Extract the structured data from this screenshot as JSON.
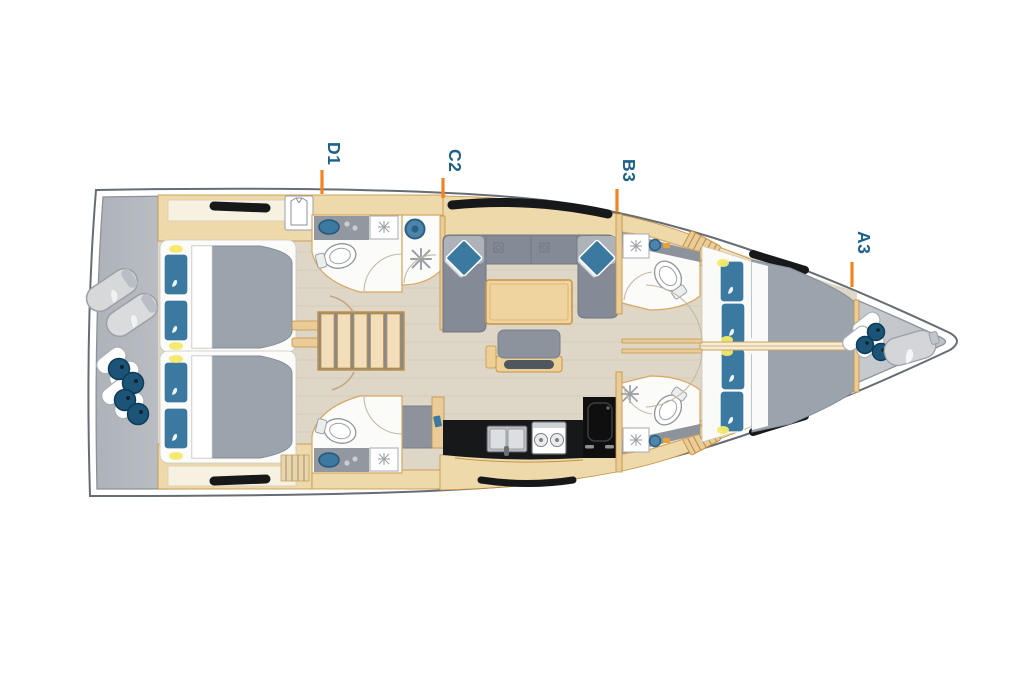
{
  "plan": {
    "type": "sailing-yacht-deck-plan",
    "cabin_labels": [
      {
        "id": "cabin-d1",
        "label": "D1"
      },
      {
        "id": "cabin-c2",
        "label": "C2"
      },
      {
        "id": "cabin-b3",
        "label": "B3"
      },
      {
        "id": "cabin-a3",
        "label": "A3"
      }
    ],
    "colors": {
      "label_text": "#1b6189",
      "marker_line": "#f58220",
      "hull_outline": "#666d74",
      "deck_gray": "#c3c8cd",
      "floor": "#ded6c6",
      "wood_light": "#eed9ab",
      "wood_stroke": "#c6913e",
      "upholstery_gray": "#848b96",
      "mattress_gray": "#9ba3ad",
      "pillow_blue": "#3b79a1",
      "fender_teal": "#1b5476",
      "counter_black": "#17181a",
      "light_yellow": "#f3e969"
    },
    "elements": [
      "hull",
      "stern-deck",
      "bow-locker",
      "aft-port-cabin",
      "aft-starboard-cabin",
      "companionway-stairs",
      "aft-port-head",
      "shower-stall",
      "saloon-sofa",
      "saloon-table",
      "saloon-bench",
      "galley",
      "fridge",
      "nav-seat",
      "fwd-port-head",
      "fwd-starboard-head",
      "fwd-port-berth",
      "fwd-starboard-berth",
      "fenders",
      "fender-bag",
      "wardrobe",
      "deck-hatches"
    ]
  }
}
